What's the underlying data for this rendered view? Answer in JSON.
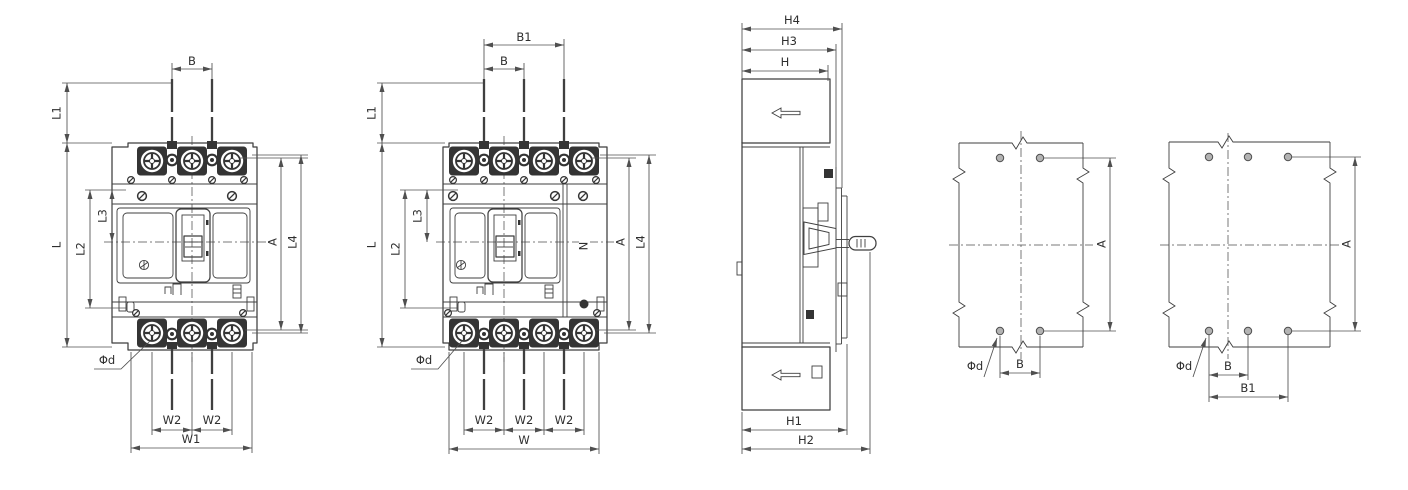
{
  "labels": {
    "B": "B",
    "B1": "B1",
    "L": "L",
    "L1": "L1",
    "L2": "L2",
    "L3": "L3",
    "L4": "L4",
    "A": "A",
    "N": "N",
    "W": "W",
    "W1": "W1",
    "W2": "W2",
    "H": "H",
    "H1": "H1",
    "H2": "H2",
    "H3": "H3",
    "H4": "H4",
    "phi_d": "Φd"
  },
  "colors": {
    "background": "#ffffff",
    "line": "#3f3f3f",
    "dark": "#343434",
    "dim_line": "#4f4f4f",
    "text": "#2e2e2e",
    "hole_fill": "#b3b3b3"
  }
}
